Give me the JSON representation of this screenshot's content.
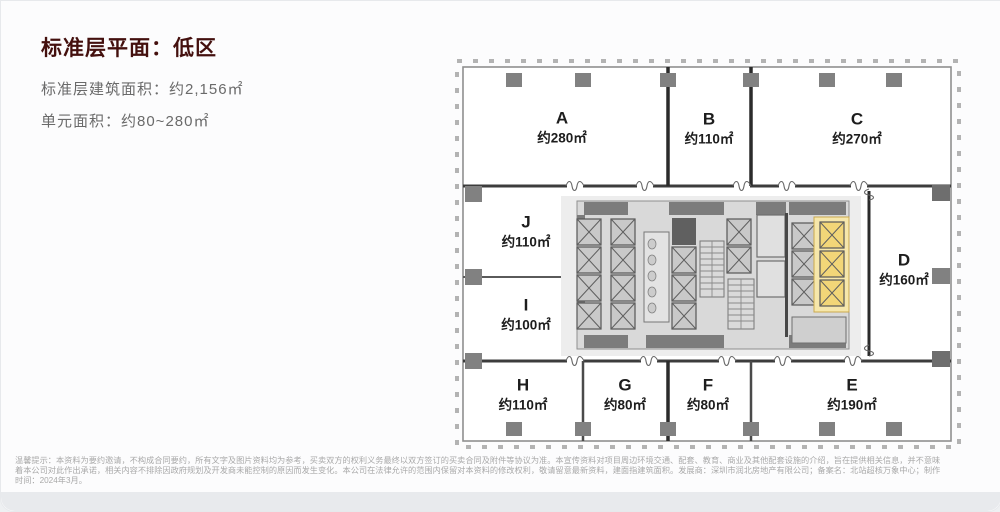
{
  "header": {
    "title": "标准层平面：低区",
    "line1": "标准层建筑面积：约2,156㎡",
    "line2": "单元面积：约80~280㎡"
  },
  "floor_plan": {
    "units": [
      {
        "id": "A",
        "area": "约280㎡"
      },
      {
        "id": "B",
        "area": "约110㎡"
      },
      {
        "id": "C",
        "area": "约270㎡"
      },
      {
        "id": "D",
        "area": "约160㎡"
      },
      {
        "id": "E",
        "area": "约190㎡"
      },
      {
        "id": "F",
        "area": "约80㎡"
      },
      {
        "id": "G",
        "area": "约80㎡"
      },
      {
        "id": "H",
        "area": "约110㎡"
      },
      {
        "id": "I",
        "area": "约100㎡"
      },
      {
        "id": "J",
        "area": "约110㎡"
      }
    ],
    "colors": {
      "highlight": "#f2d678",
      "highlight_bg": "#f6e7ab",
      "column": "#818181",
      "wall": "#2f2f2f",
      "core_fill": "#d9d9d9"
    }
  },
  "disclaimer": {
    "line1": "温馨提示：本资料为要约邀请，不构成合同要约，所有文字及图片资料均为参考，买卖双方的权利义务最终以双方签订的买卖合同及附件等协议为准。本宣传资料对项目周边环境交通、配套、教育、商业及其他配套设施的介绍，旨在提供相关信息，并不意味",
    "line2": "着本公司对此作出承诺，相关内容不排除因政府规划及开发商未能控制的原因而发生变化。本公司在法律允许的范围内保留对本资料的修改权利，敬请留意最新资料，建面指建筑面积。发展商：深圳市润北房地产有限公司；备案名：北站超核万象中心；制作",
    "line3": "时间：2024年3月。"
  }
}
